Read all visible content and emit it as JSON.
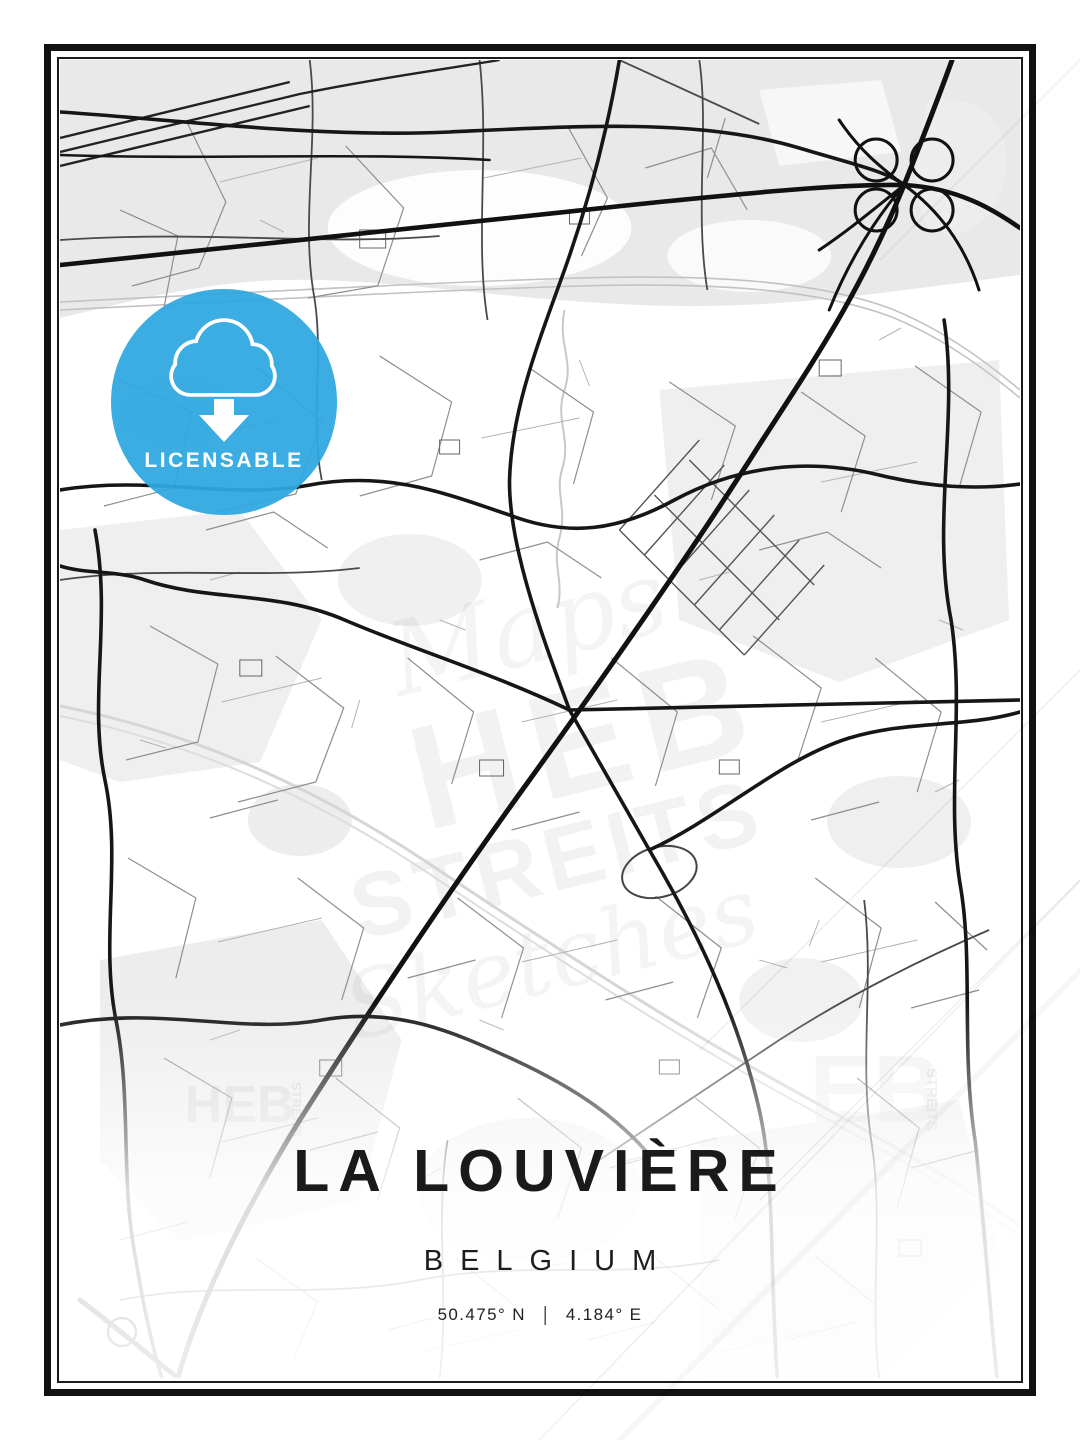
{
  "poster": {
    "city": "LA LOUVIÈRE",
    "country": "BELGIUM",
    "latitude": "50.475° N",
    "separator": "|",
    "longitude": "4.184° E"
  },
  "badge": {
    "label": "LICENSABLE",
    "icon": "cloud-download-icon",
    "color": "#2FA8E1"
  },
  "watermark": {
    "script_top": "Maps",
    "brand": "HEB",
    "brand2": "STREITS",
    "script_bottom": "Sketches",
    "corner_bl_brand": "HEB",
    "corner_bl_side": "STREITS",
    "corner_br_brand": "EB",
    "corner_br_side": "STREITS"
  },
  "map": {
    "colors": {
      "road_major": "#161616",
      "road_medium": "#4a4a4a",
      "road_minor": "#8e8e8e",
      "landuse": "#ededed",
      "railway": "#c2c2c2",
      "frame": "#111111",
      "badge_blue": "#2FA8E1"
    }
  }
}
